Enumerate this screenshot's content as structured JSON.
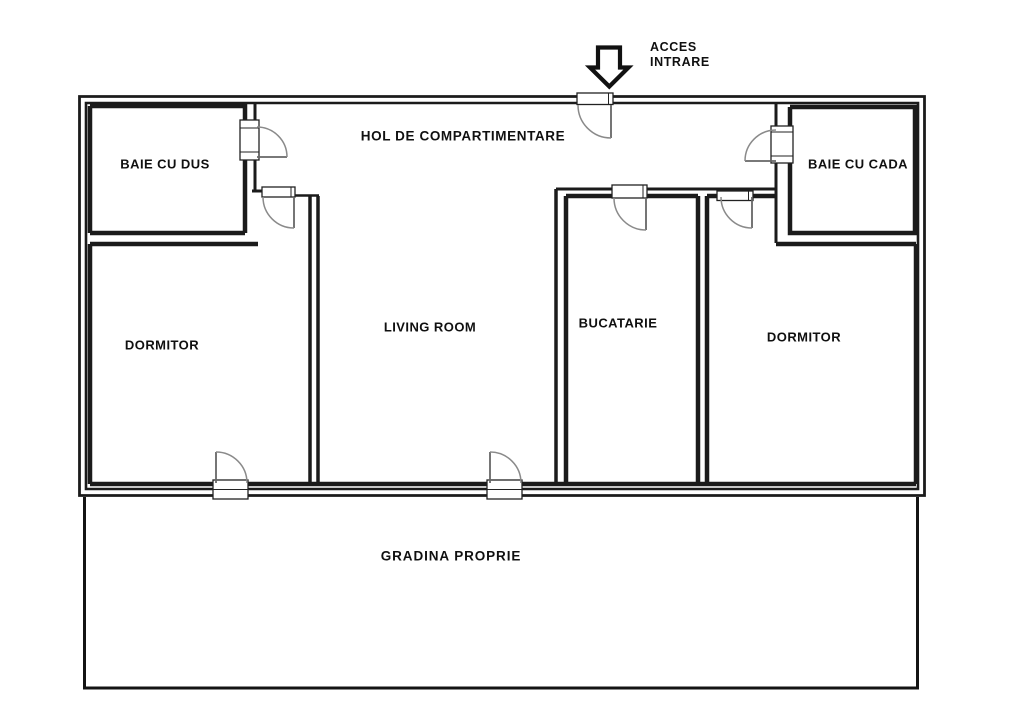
{
  "plan": {
    "entrance": {
      "line1": "ACCES",
      "line2": "INTRARE"
    },
    "rooms": {
      "hall": "HOL DE COMPARTIMENTARE",
      "bath_shower": "BAIE CU DUS",
      "bath_tub": "BAIE CU CADA",
      "bedroom_left": "DORMITOR",
      "living_room": "LIVING ROOM",
      "kitchen": "BUCATARIE",
      "bedroom_right": "DORMITOR",
      "garden": "GRADINA PROPRIE"
    },
    "colors": {
      "wall": "#1b1b1b",
      "door_arc": "#8a8a8a",
      "door_panel": "#666666",
      "background": "#ffffff"
    },
    "door_count": 8
  }
}
